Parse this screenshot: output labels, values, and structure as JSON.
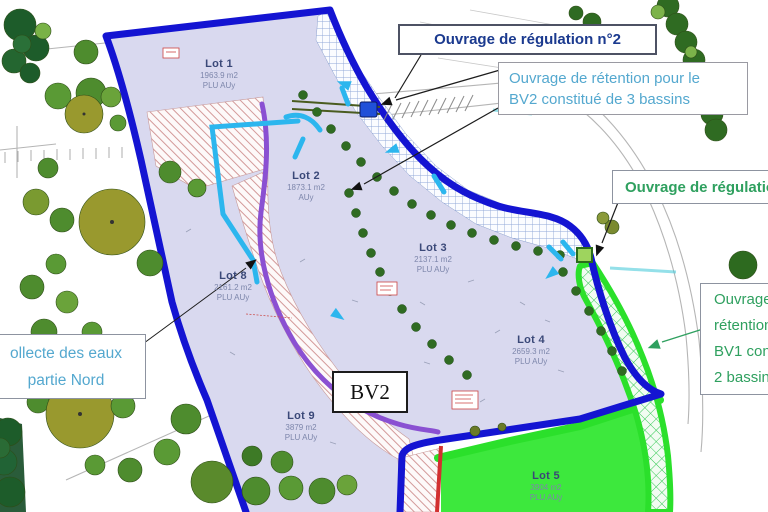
{
  "annotations": {
    "regulation2": {
      "text": "Ouvrage de régulation n°2"
    },
    "retention_bv2": {
      "line1": "Ouvrage de rétention pour le",
      "line2": "BV2 constitué de 3 bassins"
    },
    "regulation1": {
      "text": "Ouvrage de régulation"
    },
    "retention_bv1": {
      "lines": [
        "Ouvrage",
        "rétention",
        "BV1 con",
        "2 bassins"
      ]
    },
    "collecte": {
      "line1": "ollecte des eaux",
      "line2": "partie Nord"
    },
    "bv2_label": "BV2"
  },
  "lots": [
    {
      "name": "Lot 1",
      "area": "1963.9 m2",
      "zoning": "PLU AUy"
    },
    {
      "name": "Lot 2",
      "area": "1873.1 m2",
      "zoning": "AUy"
    },
    {
      "name": "Lot 3",
      "area": "2137.1 m2",
      "zoning": "PLU AUy"
    },
    {
      "name": "Lot 4",
      "area": "2659.3 m2",
      "zoning": "PLU AUy"
    },
    {
      "name": "Lot 5",
      "area": "3904 m2",
      "zoning": "PLU AUy"
    },
    {
      "name": "Lot 8",
      "area": "2161.2 m2",
      "zoning": "PLU AUy"
    },
    {
      "name": "Lot 9",
      "area": "3879 m2",
      "zoning": "PLU AUy"
    }
  ],
  "map_markers": [
    {
      "name": "regulation-basin-2-marker",
      "shape": "blue-square",
      "color": "#2050d8"
    },
    {
      "name": "regulation-basin-1-marker",
      "shape": "green-square",
      "color": "#9ed45e"
    }
  ],
  "colors": {
    "site_fill": "#d9d9ef",
    "boundary_blue": "#1414d2",
    "bv1_green": "#2be02b",
    "lot5_fill": "#3de83d",
    "drain_cyan": "#2cb6ee",
    "path_purple": "#8a50d2",
    "red_line": "#d23030",
    "annotation_blue_dark": "#1b3a8f",
    "annotation_blue_light": "#54a8cf",
    "annotation_green": "#2fa05f"
  }
}
